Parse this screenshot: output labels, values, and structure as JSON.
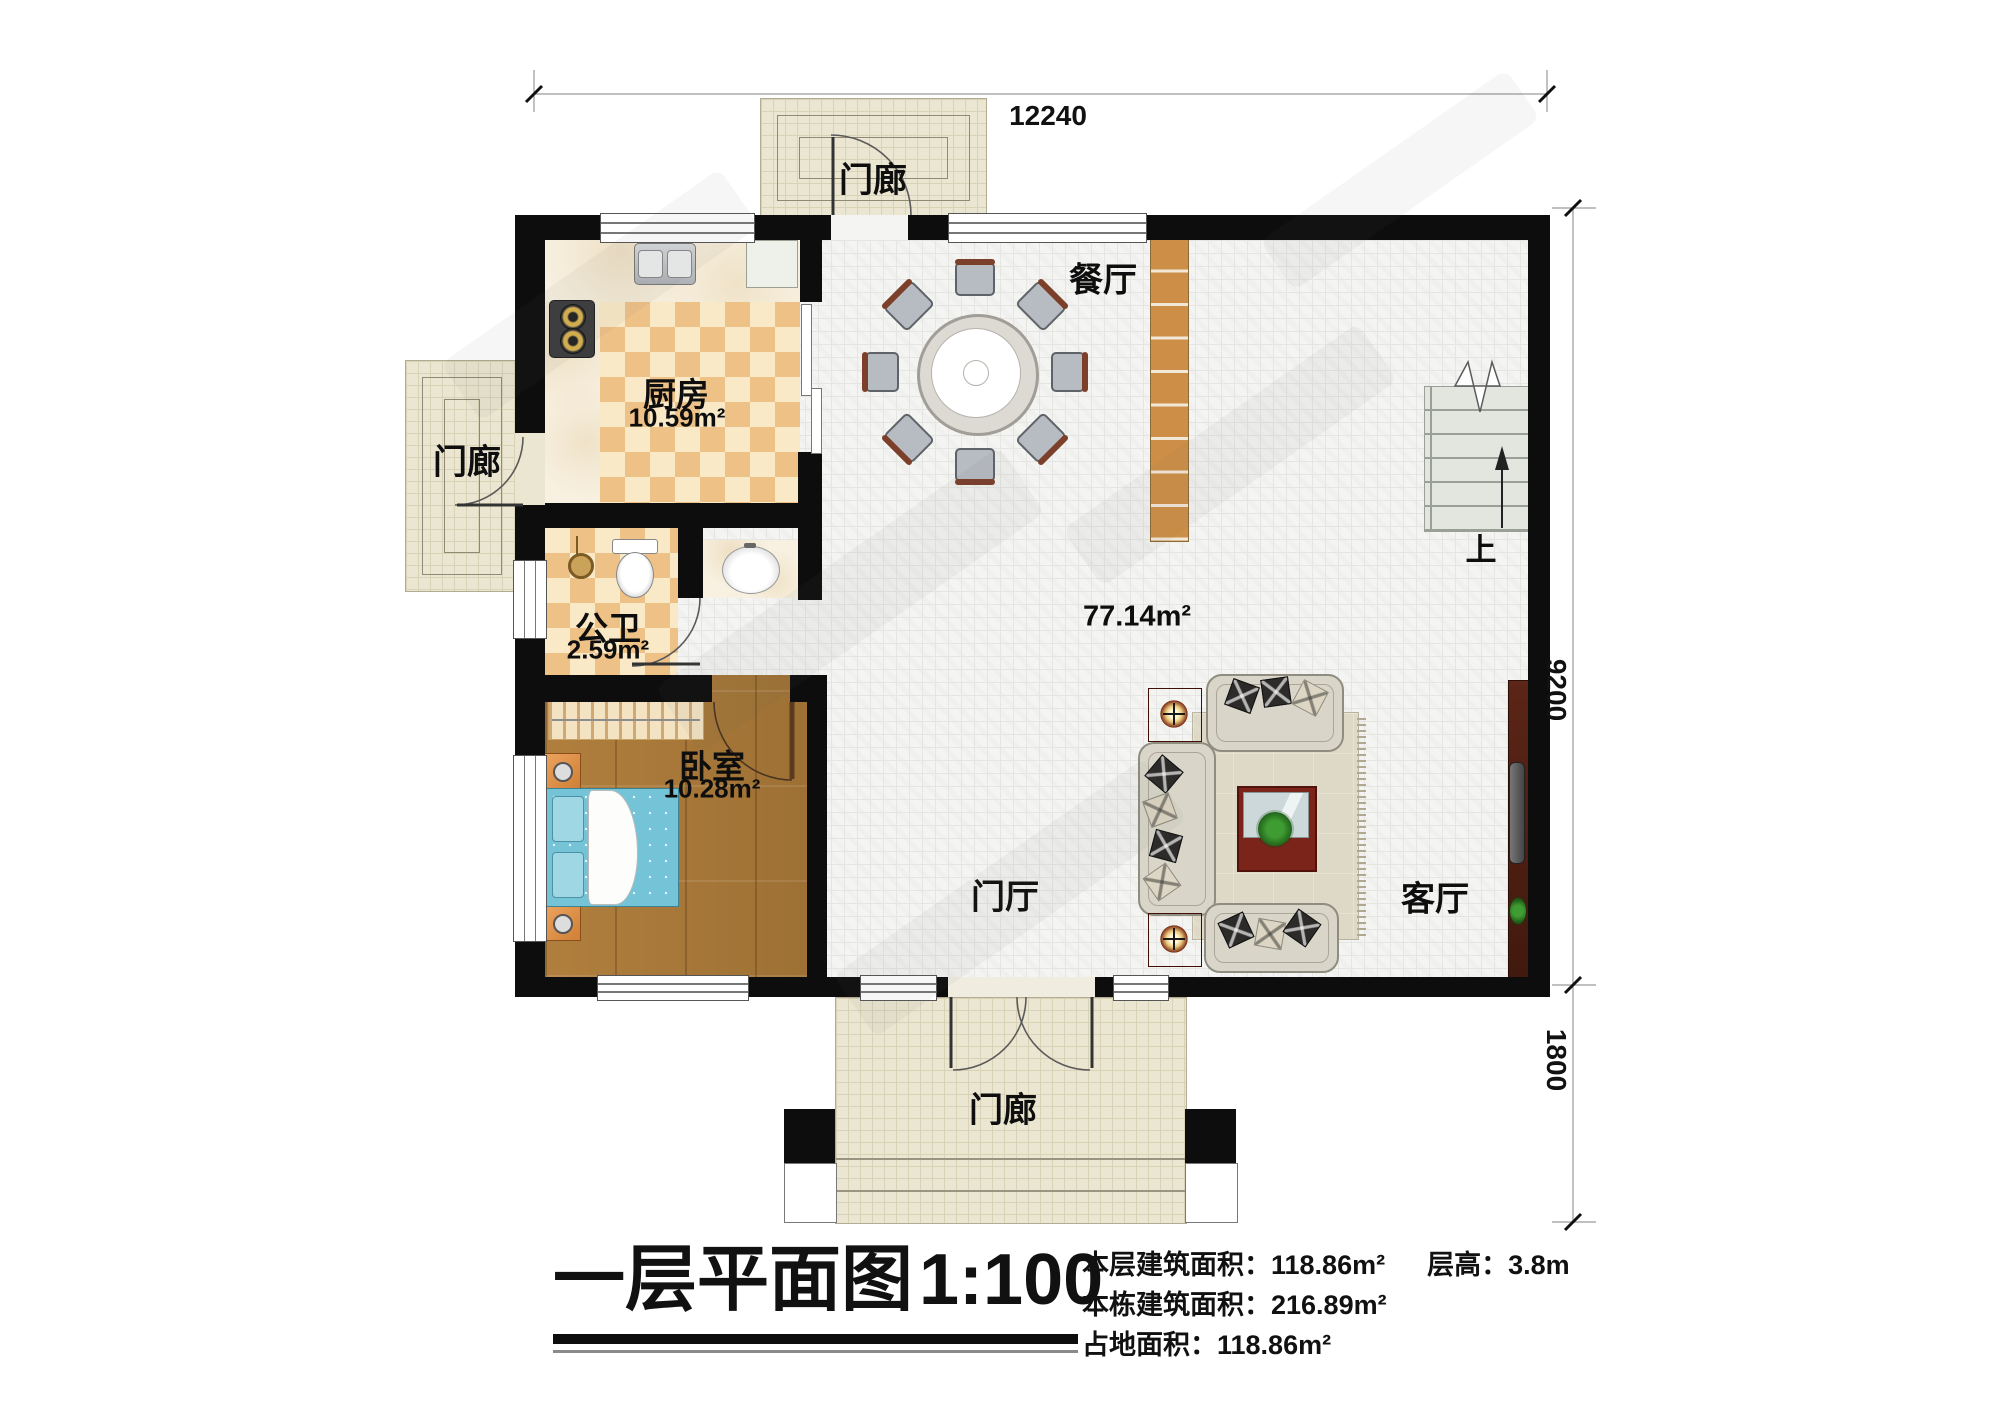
{
  "title": {
    "text": "一层平面图",
    "scale": "1:100"
  },
  "stats": {
    "floor_area_label": "本层建筑面积：",
    "floor_area_value": "118.86m²",
    "storey_height_label": "层高：",
    "storey_height_value": "3.8m",
    "building_area_label": "本栋建筑面积：",
    "building_area_value": "216.89m²",
    "footprint_label": "占地面积：",
    "footprint_value": "118.86m²"
  },
  "dimensions": {
    "top_width": "12240",
    "right_height": "9200",
    "porch_depth": "1800"
  },
  "rooms": {
    "porch_top": {
      "label": "门廊"
    },
    "porch_left": {
      "label": "门廊"
    },
    "porch_bottom": {
      "label": "门廊"
    },
    "dining": {
      "label": "餐厅"
    },
    "kitchen": {
      "label": "厨房",
      "area": "10.59m²"
    },
    "bathroom": {
      "label": "公卫",
      "area": "2.59m²"
    },
    "bedroom": {
      "label": "卧室",
      "area": "10.28m²"
    },
    "hall": {
      "label": "门厅",
      "area": "77.14m²"
    },
    "living": {
      "label": "客厅"
    },
    "stairs_up": {
      "label": "上"
    }
  },
  "colors": {
    "wall": "#0d0d0d",
    "porch_tile": "#ebe6d1",
    "main_tile": "#f4f4f2",
    "checker_dark": "#eec187",
    "checker_light": "#f9e9c6",
    "wood_floor": "#a9793a",
    "bed": "#74c3d6",
    "cabinet_wood": "#cd8f47",
    "furniture_dark_red": "#6e1d12",
    "rug": "#ded8c6",
    "stairs": "#e2e6de"
  }
}
